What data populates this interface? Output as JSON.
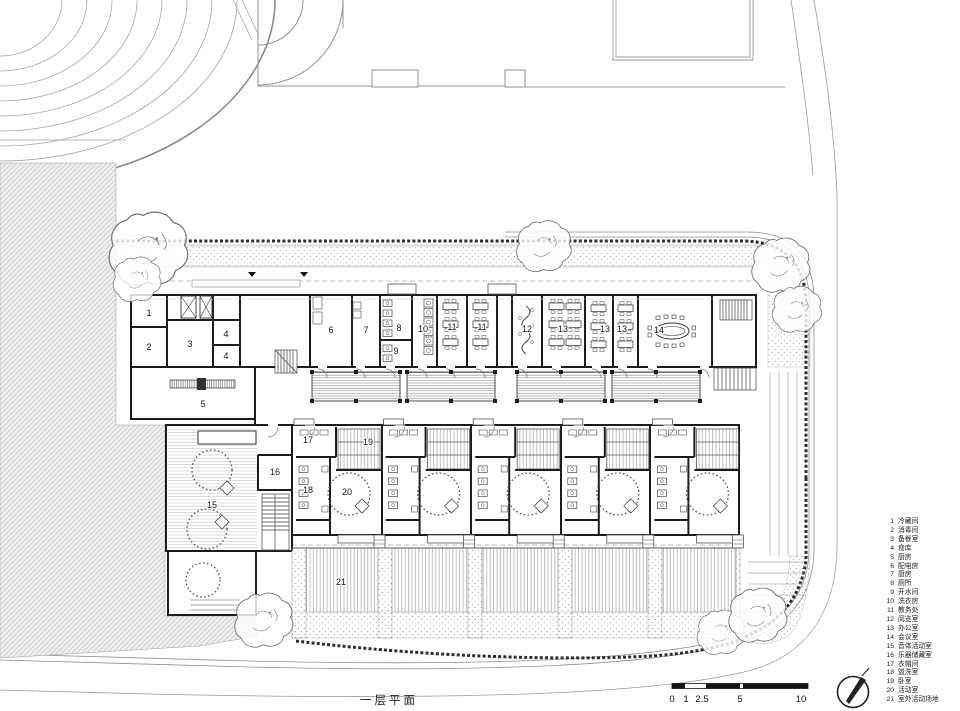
{
  "title": {
    "label": "一层平面"
  },
  "colors": {
    "paper": "#ffffff",
    "ink": "#1c1c1c",
    "site_line": "#9a9a9a",
    "hatch": "#b9b9b9",
    "stipple": "#9a9a9a"
  },
  "scale_bar": {
    "ticks": [
      "0",
      "1",
      "2.5",
      "5",
      "10"
    ]
  },
  "legend": {
    "items": [
      {
        "no": "1",
        "label": "冷藏间"
      },
      {
        "no": "2",
        "label": "消毒间"
      },
      {
        "no": "3",
        "label": "备餐室"
      },
      {
        "no": "4",
        "label": "食库"
      },
      {
        "no": "5",
        "label": "厨房"
      },
      {
        "no": "6",
        "label": "配电房"
      },
      {
        "no": "7",
        "label": "厨房"
      },
      {
        "no": "8",
        "label": "厕所"
      },
      {
        "no": "9",
        "label": "开水间"
      },
      {
        "no": "10",
        "label": "洗衣房"
      },
      {
        "no": "11",
        "label": "教务处"
      },
      {
        "no": "12",
        "label": "阅览室"
      },
      {
        "no": "13",
        "label": "办公室"
      },
      {
        "no": "14",
        "label": "会议室"
      },
      {
        "no": "15",
        "label": "音体活动室"
      },
      {
        "no": "16",
        "label": "乐器储藏室"
      },
      {
        "no": "17",
        "label": "衣帽间"
      },
      {
        "no": "18",
        "label": "盥洗室"
      },
      {
        "no": "19",
        "label": "卧室"
      },
      {
        "no": "20",
        "label": "活动室"
      },
      {
        "no": "21",
        "label": "室外活动场地"
      }
    ]
  },
  "plan_labels": [
    {
      "t": "1",
      "x": 149,
      "y": 316
    },
    {
      "t": "2",
      "x": 149,
      "y": 350
    },
    {
      "t": "3",
      "x": 190,
      "y": 347
    },
    {
      "t": "4",
      "x": 226,
      "y": 337
    },
    {
      "t": "4",
      "x": 226,
      "y": 359
    },
    {
      "t": "5",
      "x": 203,
      "y": 407
    },
    {
      "t": "6",
      "x": 331,
      "y": 333
    },
    {
      "t": "7",
      "x": 366,
      "y": 333
    },
    {
      "t": "8",
      "x": 399,
      "y": 331
    },
    {
      "t": "9",
      "x": 396,
      "y": 354
    },
    {
      "t": "10",
      "x": 423,
      "y": 332
    },
    {
      "t": "11",
      "x": 452,
      "y": 330
    },
    {
      "t": "11",
      "x": 482,
      "y": 330
    },
    {
      "t": "12",
      "x": 527,
      "y": 332
    },
    {
      "t": "13",
      "x": 563,
      "y": 332
    },
    {
      "t": "13",
      "x": 605,
      "y": 332
    },
    {
      "t": "13",
      "x": 622,
      "y": 332
    },
    {
      "t": "14",
      "x": 659,
      "y": 333
    },
    {
      "t": "15",
      "x": 212,
      "y": 508
    },
    {
      "t": "16",
      "x": 275,
      "y": 475
    },
    {
      "t": "17",
      "x": 308,
      "y": 443
    },
    {
      "t": "18",
      "x": 308,
      "y": 493
    },
    {
      "t": "19",
      "x": 368,
      "y": 445
    },
    {
      "t": "20",
      "x": 347,
      "y": 495
    },
    {
      "t": "21",
      "x": 341,
      "y": 585
    }
  ]
}
